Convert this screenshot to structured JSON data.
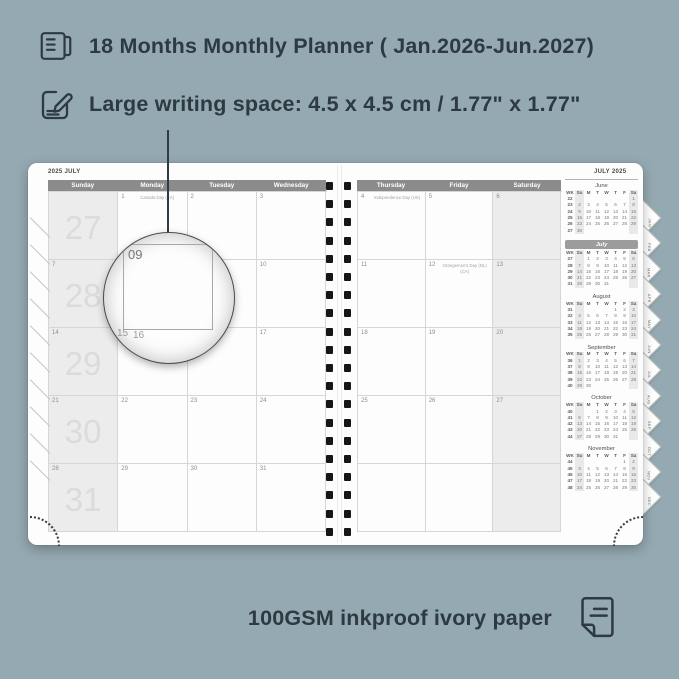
{
  "colors": {
    "background": "#95a9b2",
    "ink": "#2d3a42",
    "page": "#fdfdfd",
    "header_bar": "#8b8b8b",
    "weekend_fill": "#ececec",
    "week_number_big": "#dbdbdb",
    "grid_line": "#d6d6d6",
    "binding_hole": "#161616"
  },
  "headline": {
    "icon": "book-icon",
    "text": "18 Months Monthly Planner ( Jan.2026-Jun.2027)"
  },
  "subheadline": {
    "icon": "pencil-note-icon",
    "text": "Large writing space: 4.5 x 4.5 cm / 1.77\" x 1.77\""
  },
  "footer": {
    "text": "100GSM inkproof ivory paper",
    "icon": "paper-icon"
  },
  "planner": {
    "left_page": {
      "corner_label": "2025 JULY",
      "day_headers": [
        "Sunday",
        "Monday",
        "Tuesday",
        "Wednesday"
      ],
      "weeks": [
        {
          "week_number": "27",
          "sunday_date": "",
          "cells": [
            {
              "date": "1",
              "note": "Canada Day (CA)"
            },
            {
              "date": "2",
              "note": ""
            },
            {
              "date": "3",
              "note": ""
            }
          ]
        },
        {
          "week_number": "28",
          "sunday_date": "7",
          "cells": [
            {
              "date": "8",
              "note": ""
            },
            {
              "date": "9",
              "note": ""
            },
            {
              "date": "10",
              "note": ""
            }
          ]
        },
        {
          "week_number": "29",
          "sunday_date": "14",
          "cells": [
            {
              "date": "15",
              "note": ""
            },
            {
              "date": "16",
              "note": ""
            },
            {
              "date": "17",
              "note": ""
            }
          ]
        },
        {
          "week_number": "30",
          "sunday_date": "21",
          "cells": [
            {
              "date": "22",
              "note": ""
            },
            {
              "date": "23",
              "note": ""
            },
            {
              "date": "24",
              "note": ""
            }
          ]
        },
        {
          "week_number": "31",
          "sunday_date": "28",
          "cells": [
            {
              "date": "29",
              "note": ""
            },
            {
              "date": "30",
              "note": ""
            },
            {
              "date": "31",
              "note": ""
            }
          ]
        }
      ]
    },
    "right_page": {
      "corner_label": "JULY 2025",
      "day_headers": [
        "Thursday",
        "Friday",
        "Saturday"
      ],
      "weeks": [
        {
          "cells": [
            {
              "date": "4",
              "note": "Independence Day (US)"
            },
            {
              "date": "5",
              "note": ""
            },
            {
              "date": "6",
              "note": ""
            }
          ]
        },
        {
          "cells": [
            {
              "date": "11",
              "note": ""
            },
            {
              "date": "12",
              "note": "Orangemen's Day (NL) (CA)"
            },
            {
              "date": "13",
              "note": ""
            }
          ]
        },
        {
          "cells": [
            {
              "date": "18",
              "note": ""
            },
            {
              "date": "19",
              "note": ""
            },
            {
              "date": "20",
              "note": ""
            }
          ]
        },
        {
          "cells": [
            {
              "date": "25",
              "note": ""
            },
            {
              "date": "26",
              "note": ""
            },
            {
              "date": "27",
              "note": ""
            }
          ]
        },
        {
          "cells": [
            {
              "date": "",
              "note": ""
            },
            {
              "date": "",
              "note": ""
            },
            {
              "date": "",
              "note": ""
            }
          ]
        }
      ]
    },
    "magnifier": {
      "date_label": "09",
      "next_row_labels": [
        "15",
        "16"
      ]
    },
    "sidebar": {
      "col_headers": [
        "WK",
        "Su",
        "M",
        "T",
        "W",
        "T",
        "F",
        "Sa"
      ],
      "mini_calendars": [
        {
          "name": "June",
          "highlight": false,
          "rows": [
            [
              "22",
              "",
              "",
              "",
              "",
              "",
              "",
              "1"
            ],
            [
              "23",
              "2",
              "3",
              "4",
              "5",
              "6",
              "7",
              "8"
            ],
            [
              "24",
              "9",
              "10",
              "11",
              "12",
              "13",
              "14",
              "15"
            ],
            [
              "25",
              "16",
              "17",
              "18",
              "19",
              "20",
              "21",
              "22"
            ],
            [
              "26",
              "23",
              "24",
              "25",
              "26",
              "27",
              "28",
              "29"
            ],
            [
              "27",
              "30",
              "",
              "",
              "",
              "",
              "",
              ""
            ]
          ]
        },
        {
          "name": "July",
          "highlight": true,
          "rows": [
            [
              "27",
              "",
              "1",
              "2",
              "3",
              "4",
              "5",
              "6"
            ],
            [
              "28",
              "7",
              "8",
              "9",
              "10",
              "11",
              "12",
              "13"
            ],
            [
              "29",
              "14",
              "15",
              "16",
              "17",
              "18",
              "19",
              "20"
            ],
            [
              "30",
              "21",
              "22",
              "23",
              "24",
              "25",
              "26",
              "27"
            ],
            [
              "31",
              "28",
              "29",
              "30",
              "31",
              "",
              "",
              ""
            ]
          ]
        },
        {
          "name": "August",
          "highlight": false,
          "rows": [
            [
              "31",
              "",
              "",
              "",
              "",
              "1",
              "2",
              "3"
            ],
            [
              "32",
              "4",
              "5",
              "6",
              "7",
              "8",
              "9",
              "10"
            ],
            [
              "33",
              "11",
              "12",
              "13",
              "14",
              "15",
              "16",
              "17"
            ],
            [
              "34",
              "18",
              "19",
              "20",
              "21",
              "22",
              "23",
              "24"
            ],
            [
              "35",
              "25",
              "26",
              "27",
              "28",
              "29",
              "30",
              "31"
            ]
          ]
        },
        {
          "name": "September",
          "highlight": false,
          "rows": [
            [
              "36",
              "1",
              "2",
              "3",
              "4",
              "5",
              "6",
              "7"
            ],
            [
              "37",
              "8",
              "9",
              "10",
              "11",
              "12",
              "13",
              "14"
            ],
            [
              "38",
              "15",
              "16",
              "17",
              "18",
              "19",
              "20",
              "21"
            ],
            [
              "39",
              "22",
              "23",
              "24",
              "25",
              "26",
              "27",
              "28"
            ],
            [
              "40",
              "29",
              "30",
              "",
              "",
              "",
              "",
              ""
            ]
          ]
        },
        {
          "name": "October",
          "highlight": false,
          "rows": [
            [
              "40",
              "",
              "",
              "1",
              "2",
              "3",
              "4",
              "5"
            ],
            [
              "41",
              "6",
              "7",
              "8",
              "9",
              "10",
              "11",
              "12"
            ],
            [
              "42",
              "13",
              "14",
              "15",
              "16",
              "17",
              "18",
              "19"
            ],
            [
              "43",
              "20",
              "21",
              "22",
              "23",
              "24",
              "25",
              "26"
            ],
            [
              "44",
              "27",
              "28",
              "29",
              "30",
              "31",
              "",
              ""
            ]
          ]
        },
        {
          "name": "November",
          "highlight": false,
          "rows": [
            [
              "44",
              "",
              "",
              "",
              "",
              "",
              "1",
              "2"
            ],
            [
              "45",
              "3",
              "4",
              "5",
              "6",
              "7",
              "8",
              "9"
            ],
            [
              "46",
              "10",
              "11",
              "12",
              "13",
              "14",
              "15",
              "16"
            ],
            [
              "47",
              "17",
              "18",
              "19",
              "20",
              "21",
              "22",
              "23"
            ],
            [
              "48",
              "24",
              "25",
              "26",
              "27",
              "28",
              "29",
              "30"
            ]
          ]
        }
      ]
    },
    "month_tabs": [
      "JAN",
      "FEB",
      "MAR",
      "APR",
      "MAY",
      "JUN",
      "JUL",
      "AUG",
      "SEP",
      "OCT",
      "NOV",
      "DEC"
    ]
  }
}
